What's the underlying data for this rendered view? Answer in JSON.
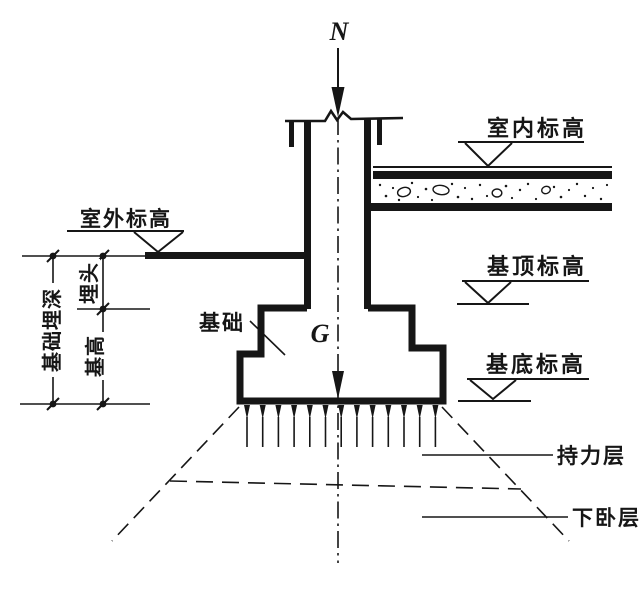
{
  "diagram": {
    "type": "building-foundation-section",
    "ink_color": "#161616",
    "paper_color": "#ffffff",
    "labels": {
      "load": "N",
      "self_weight": "G",
      "indoor_level": "室内标高",
      "outdoor_level": "室外标高",
      "foundation_top_level": "基顶标高",
      "foundation_bottom_level": "基底标高",
      "foundation": "基础",
      "bearing_layer": "持力层",
      "underlying_layer": "下卧层",
      "total_embedment_depth": "基础埋深",
      "cover_depth": "埋头",
      "foundation_height": "基高"
    }
  }
}
